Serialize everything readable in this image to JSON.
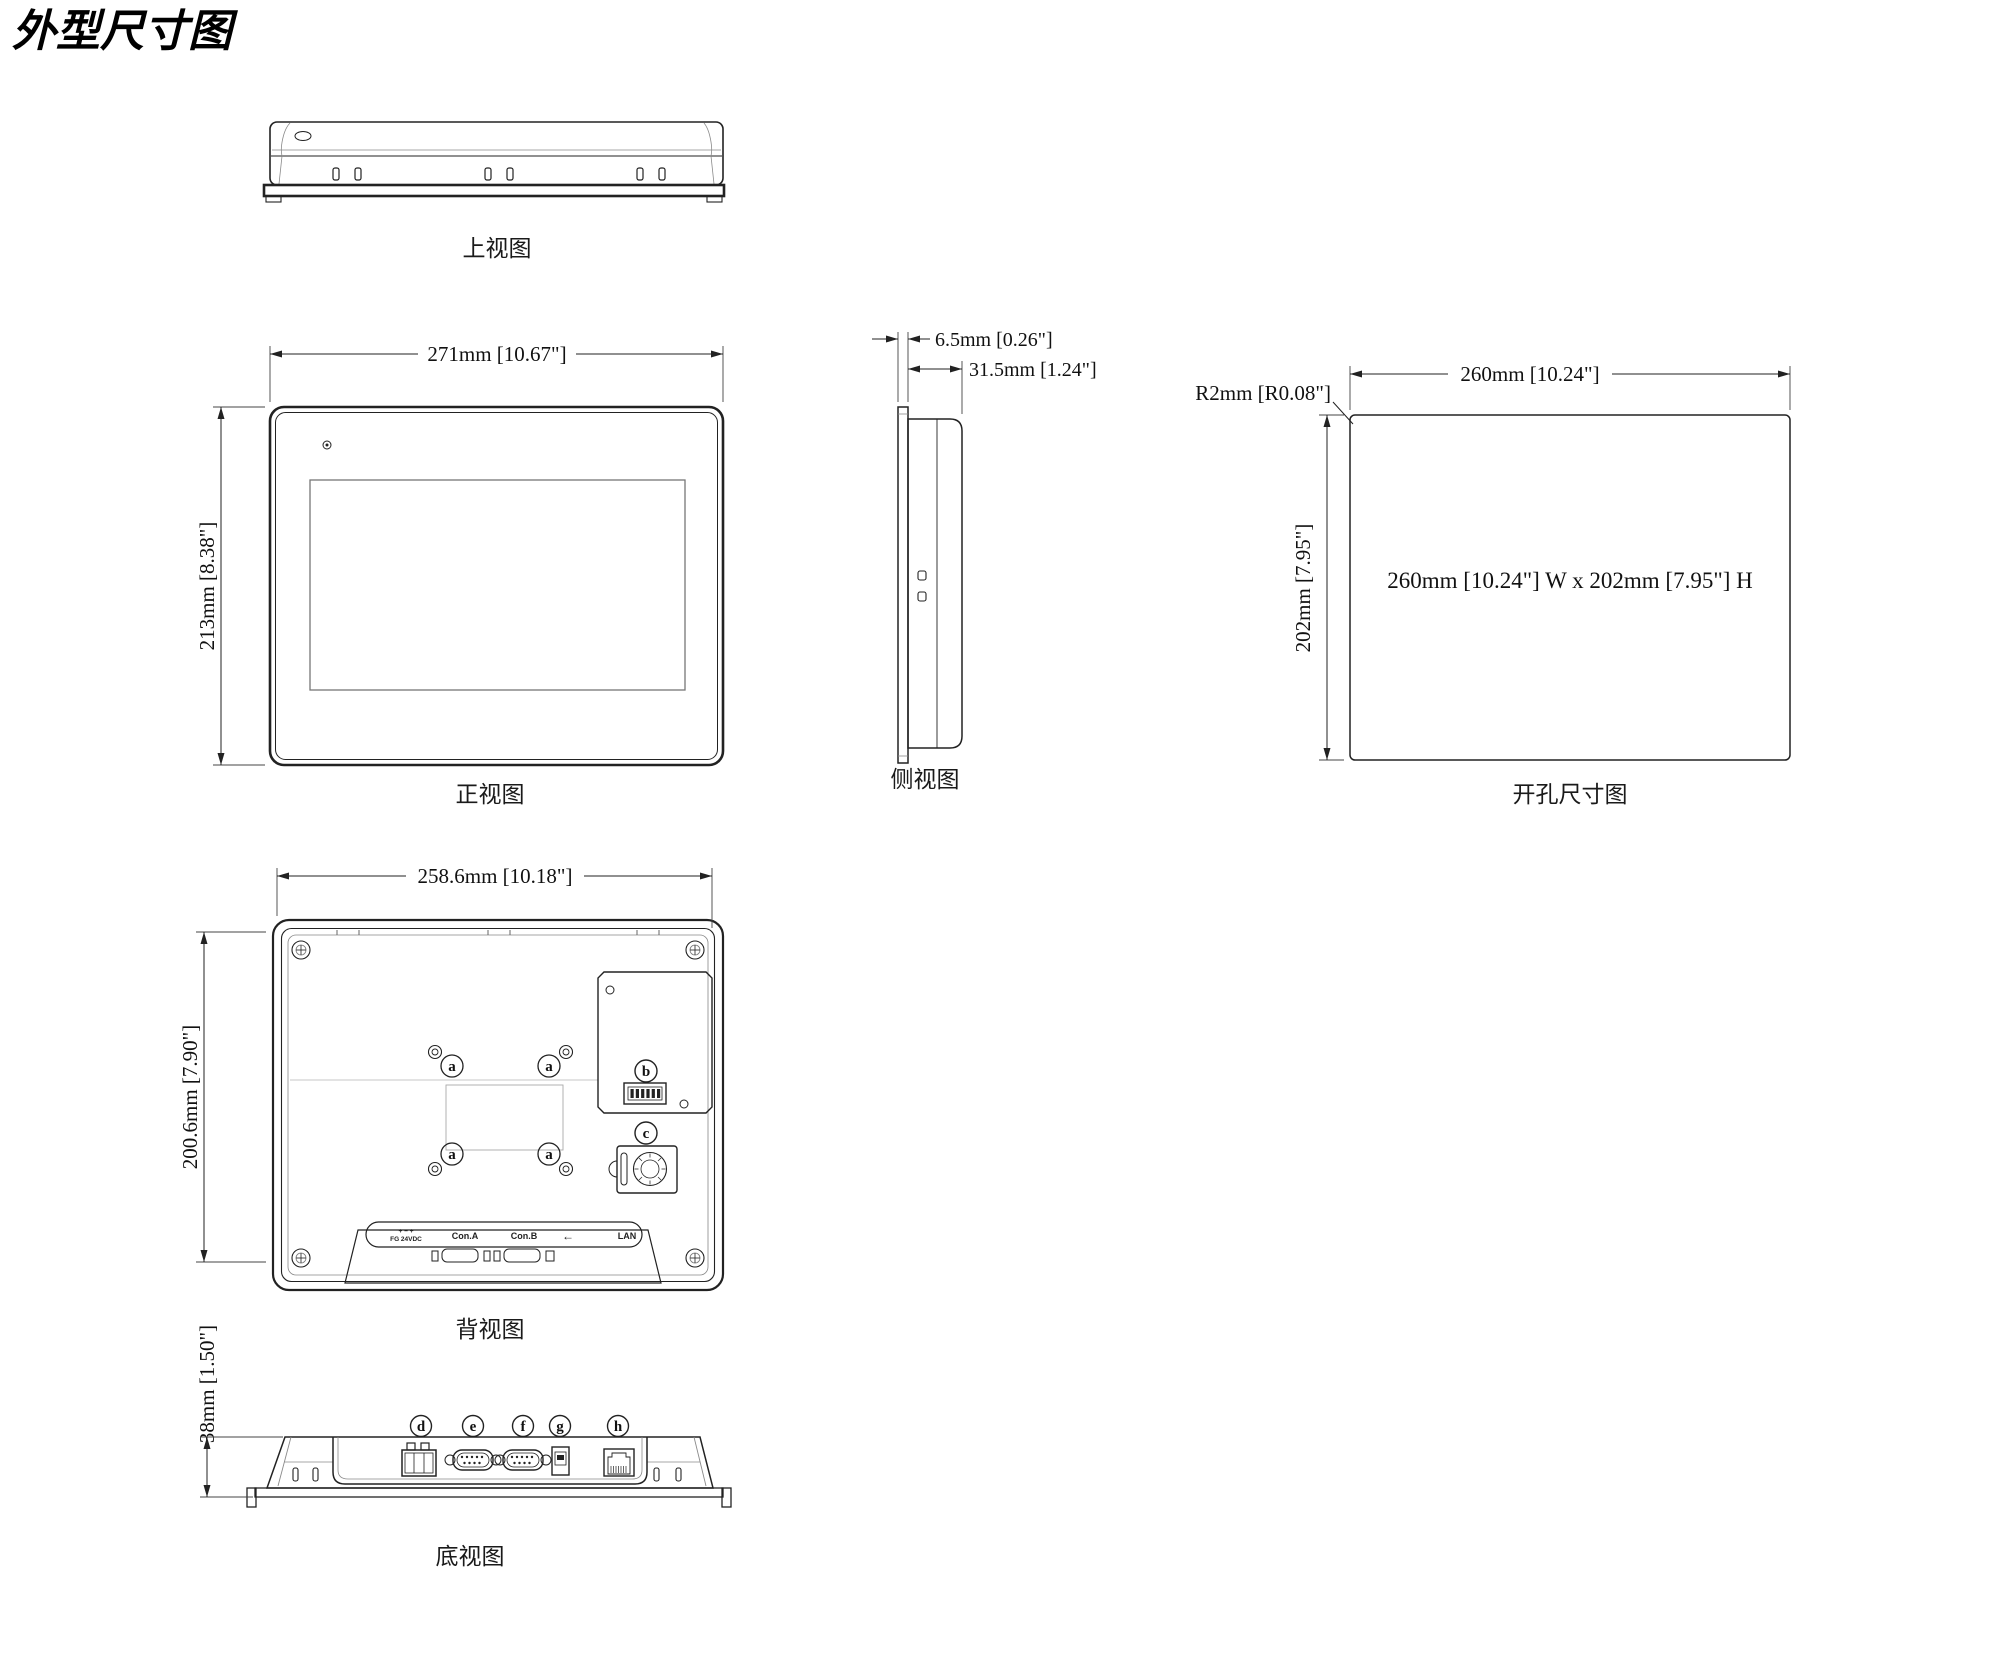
{
  "title": "外型尺寸图",
  "views": {
    "top": {
      "label": "上视图"
    },
    "front": {
      "label": "正视图",
      "width_dim": "271mm [10.67\"]",
      "height_dim": "213mm [8.38\"]"
    },
    "side": {
      "label": "侧视图",
      "flange_dim": "6.5mm [0.26\"]",
      "depth_dim": "31.5mm [1.24\"]"
    },
    "cutout": {
      "label": "开孔尺寸图",
      "width_dim": "260mm [10.24\"]",
      "height_dim": "202mm [7.95\"]",
      "corner_radius_dim": "R2mm [R0.08\"]",
      "center_text": "260mm [10.24\"] W x 202mm [7.95\"] H"
    },
    "back": {
      "label": "背视图",
      "width_dim": "258.6mm [10.18\"]",
      "height_dim": "200.6mm [7.90\"]",
      "ports": {
        "power_symbols": "+ − +",
        "power_text": "FG 24VDC",
        "con_a": "Con.A",
        "con_b": "Con.B",
        "usb_symbol": "←",
        "lan": "LAN"
      }
    },
    "bottom": {
      "label": "底视图",
      "height_dim": "38mm [1.50\"]"
    }
  },
  "tags": {
    "a": "a",
    "b": "b",
    "c": "c",
    "d": "d",
    "e": "e",
    "f": "f",
    "g": "g",
    "h": "h"
  },
  "colors": {
    "line": "#222222",
    "light_line": "#8a8a8a",
    "background": "#ffffff"
  }
}
